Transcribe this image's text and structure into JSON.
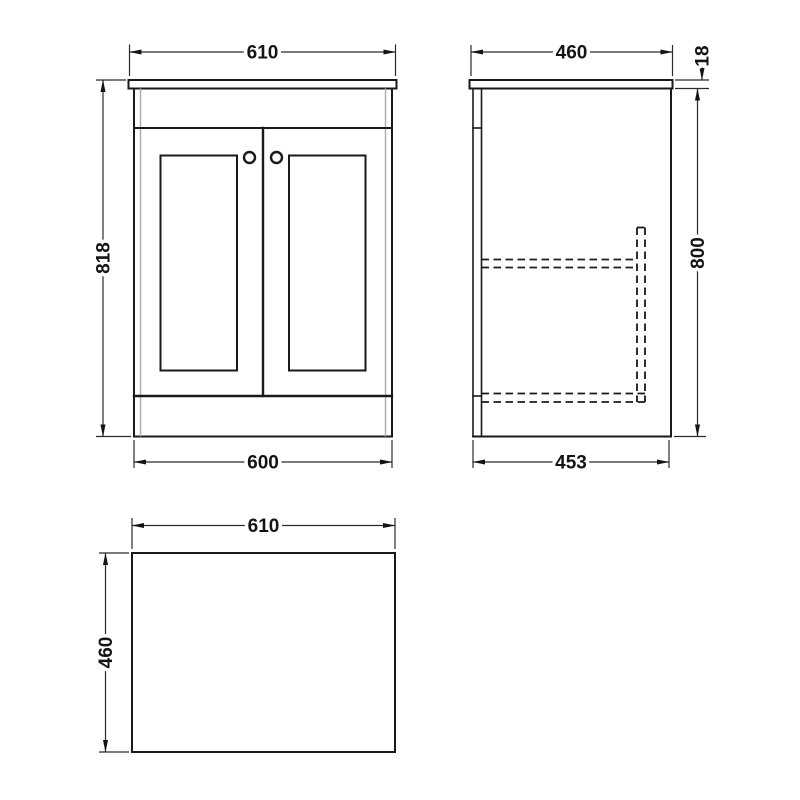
{
  "page": {
    "background": "#ffffff"
  },
  "drawing": {
    "type": "technical-dimension-drawing",
    "subject": "two-door floor-standing vanity unit with worktop, shown in front, side and plan views",
    "line_color": "#1a1a1a",
    "secondary_line_color": "#b0b0b0",
    "dim_text_color": "#141414",
    "front_view": {
      "width_top": "610",
      "height": "818",
      "width_bottom": "600"
    },
    "side_view": {
      "depth_top": "460",
      "worktop_thickness": "18",
      "body_height": "800",
      "depth_bottom": "453"
    },
    "top_view": {
      "width": "610",
      "depth": "460"
    }
  }
}
